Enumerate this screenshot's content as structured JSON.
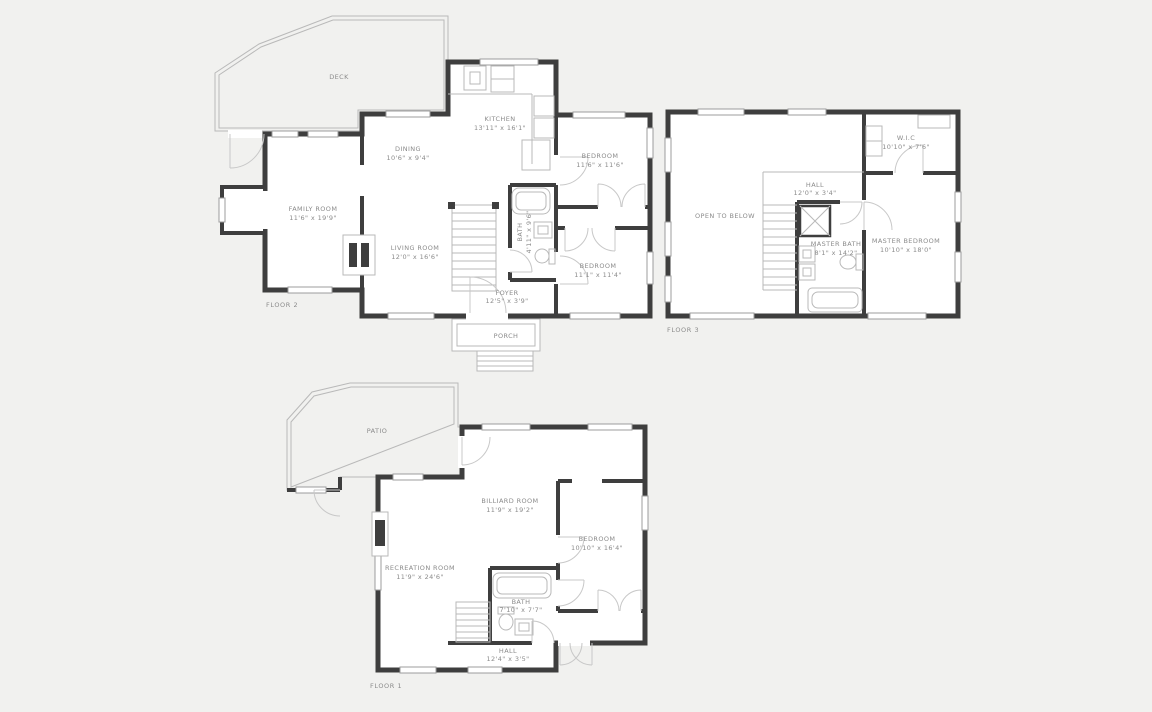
{
  "page": {
    "background_color": "#f1f1ef",
    "wall_color": "#3e3e3e",
    "fixture_line_color": "#b9b9b9",
    "label_color": "#8b8b8b"
  },
  "floors": {
    "f2": {
      "label": "FLOOR 2",
      "rooms": {
        "deck": {
          "name": "DECK"
        },
        "kitchen": {
          "name": "KITCHEN",
          "dims": "13'11\" x 16'1\""
        },
        "dining": {
          "name": "DINING",
          "dims": "10'6\" x 9'4\""
        },
        "bedroom1": {
          "name": "BEDROOM",
          "dims": "11'6\" x 11'6\""
        },
        "family": {
          "name": "FAMILY ROOM",
          "dims": "11'6\" x 19'9\""
        },
        "living": {
          "name": "LIVING ROOM",
          "dims": "12'0\" x 16'6\""
        },
        "bath": {
          "name": "BATH",
          "dims": "4'11\" x 9'6\""
        },
        "bedroom2": {
          "name": "BEDROOM",
          "dims": "11'1\" x 11'4\""
        },
        "foyer": {
          "name": "FOYER",
          "dims": "12'5\" x 3'9\""
        },
        "porch": {
          "name": "PORCH"
        }
      }
    },
    "f3": {
      "label": "FLOOR 3",
      "rooms": {
        "open": {
          "name": "OPEN TO BELOW"
        },
        "hall": {
          "name": "HALL",
          "dims": "12'0\" x 3'4\""
        },
        "wic": {
          "name": "W.I.C",
          "dims": "10'10\" x 7'6\""
        },
        "mbath": {
          "name": "MASTER BATH",
          "dims": "8'1\" x 14'2\""
        },
        "mbed": {
          "name": "MASTER BEDROOM",
          "dims": "10'10\" x 18'0\""
        }
      }
    },
    "f1": {
      "label": "FLOOR 1",
      "rooms": {
        "patio": {
          "name": "PATIO"
        },
        "billiard": {
          "name": "BILLIARD ROOM",
          "dims": "11'9\" x 19'2\""
        },
        "bedroom": {
          "name": "BEDROOM",
          "dims": "10'10\" x 16'4\""
        },
        "rec": {
          "name": "RECREATION ROOM",
          "dims": "11'9\" x 24'6\""
        },
        "bath": {
          "name": "BATH",
          "dims": "7'10\" x 7'7\""
        },
        "hall": {
          "name": "HALL",
          "dims": "12'4\" x 3'5\""
        }
      }
    }
  }
}
